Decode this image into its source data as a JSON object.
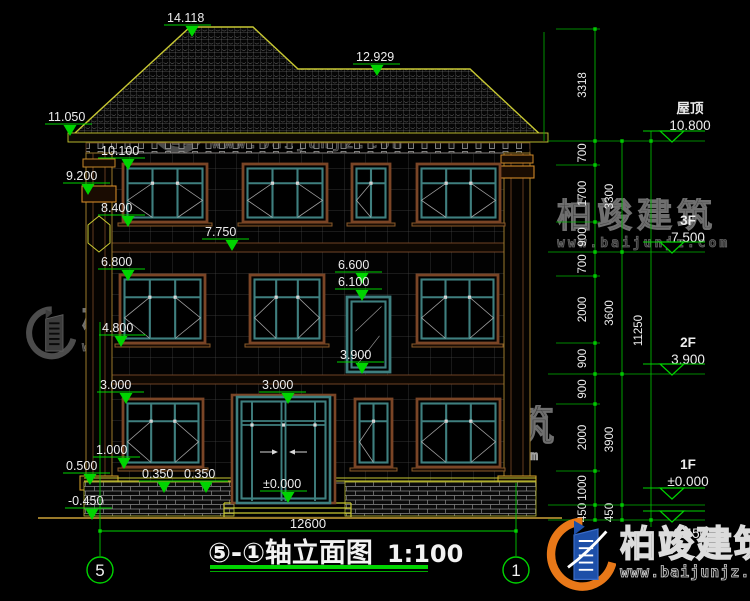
{
  "drawing": {
    "title": "⑤-①轴立面图",
    "scale": "1:100",
    "axis_left": "5",
    "axis_right": "1",
    "bottom_width": "12600"
  },
  "elevations": {
    "peak": "14.118",
    "ridge2": "12.929",
    "eave": "11.050",
    "e10_100": "10.100",
    "e9_200": "9.200",
    "e8_400": "8.400",
    "e7_750": "7.750",
    "e6_800": "6.800",
    "e6_600": "6.600",
    "e6_100": "6.100",
    "e4_800": "4.800",
    "e3_900": "3.900",
    "e3_000a": "3.000",
    "e3_000b": "3.000",
    "e1_000": "1.000",
    "e0_500": "0.500",
    "e0_350a": "0.350",
    "e0_350b": "0.350",
    "zero": "±0.000",
    "minus": "-0.450"
  },
  "floors": {
    "roof": {
      "label": "屋顶",
      "elev": "10.800"
    },
    "f3": {
      "label": "3F",
      "elev": "7.500"
    },
    "f2": {
      "label": "2F",
      "elev": "3.900"
    },
    "f1": {
      "label": "1F",
      "elev": "±0.000"
    },
    "base": {
      "elev": "-0.450"
    }
  },
  "dims": {
    "chain1": [
      "3318",
      "700",
      "1700",
      "900",
      "700",
      "2000",
      "900",
      "900",
      "2000",
      "1000",
      "450"
    ],
    "chain2": [
      "3300",
      "3600",
      "3900",
      "450"
    ],
    "chain3": [
      "11250"
    ]
  },
  "watermark": {
    "name": "柏竣建筑",
    "url": "www.baijunjz.com"
  },
  "logo": {
    "name": "柏竣建筑",
    "url": "www.baijunjz.com"
  },
  "palette": {
    "dim_green": "#00d400",
    "roof_yellow": "#c8c814",
    "frame_teal": "#3f7f7f",
    "frame_brown": "#7a4526",
    "logo_blue": "#1d4fa8",
    "logo_orange": "#e87818"
  }
}
